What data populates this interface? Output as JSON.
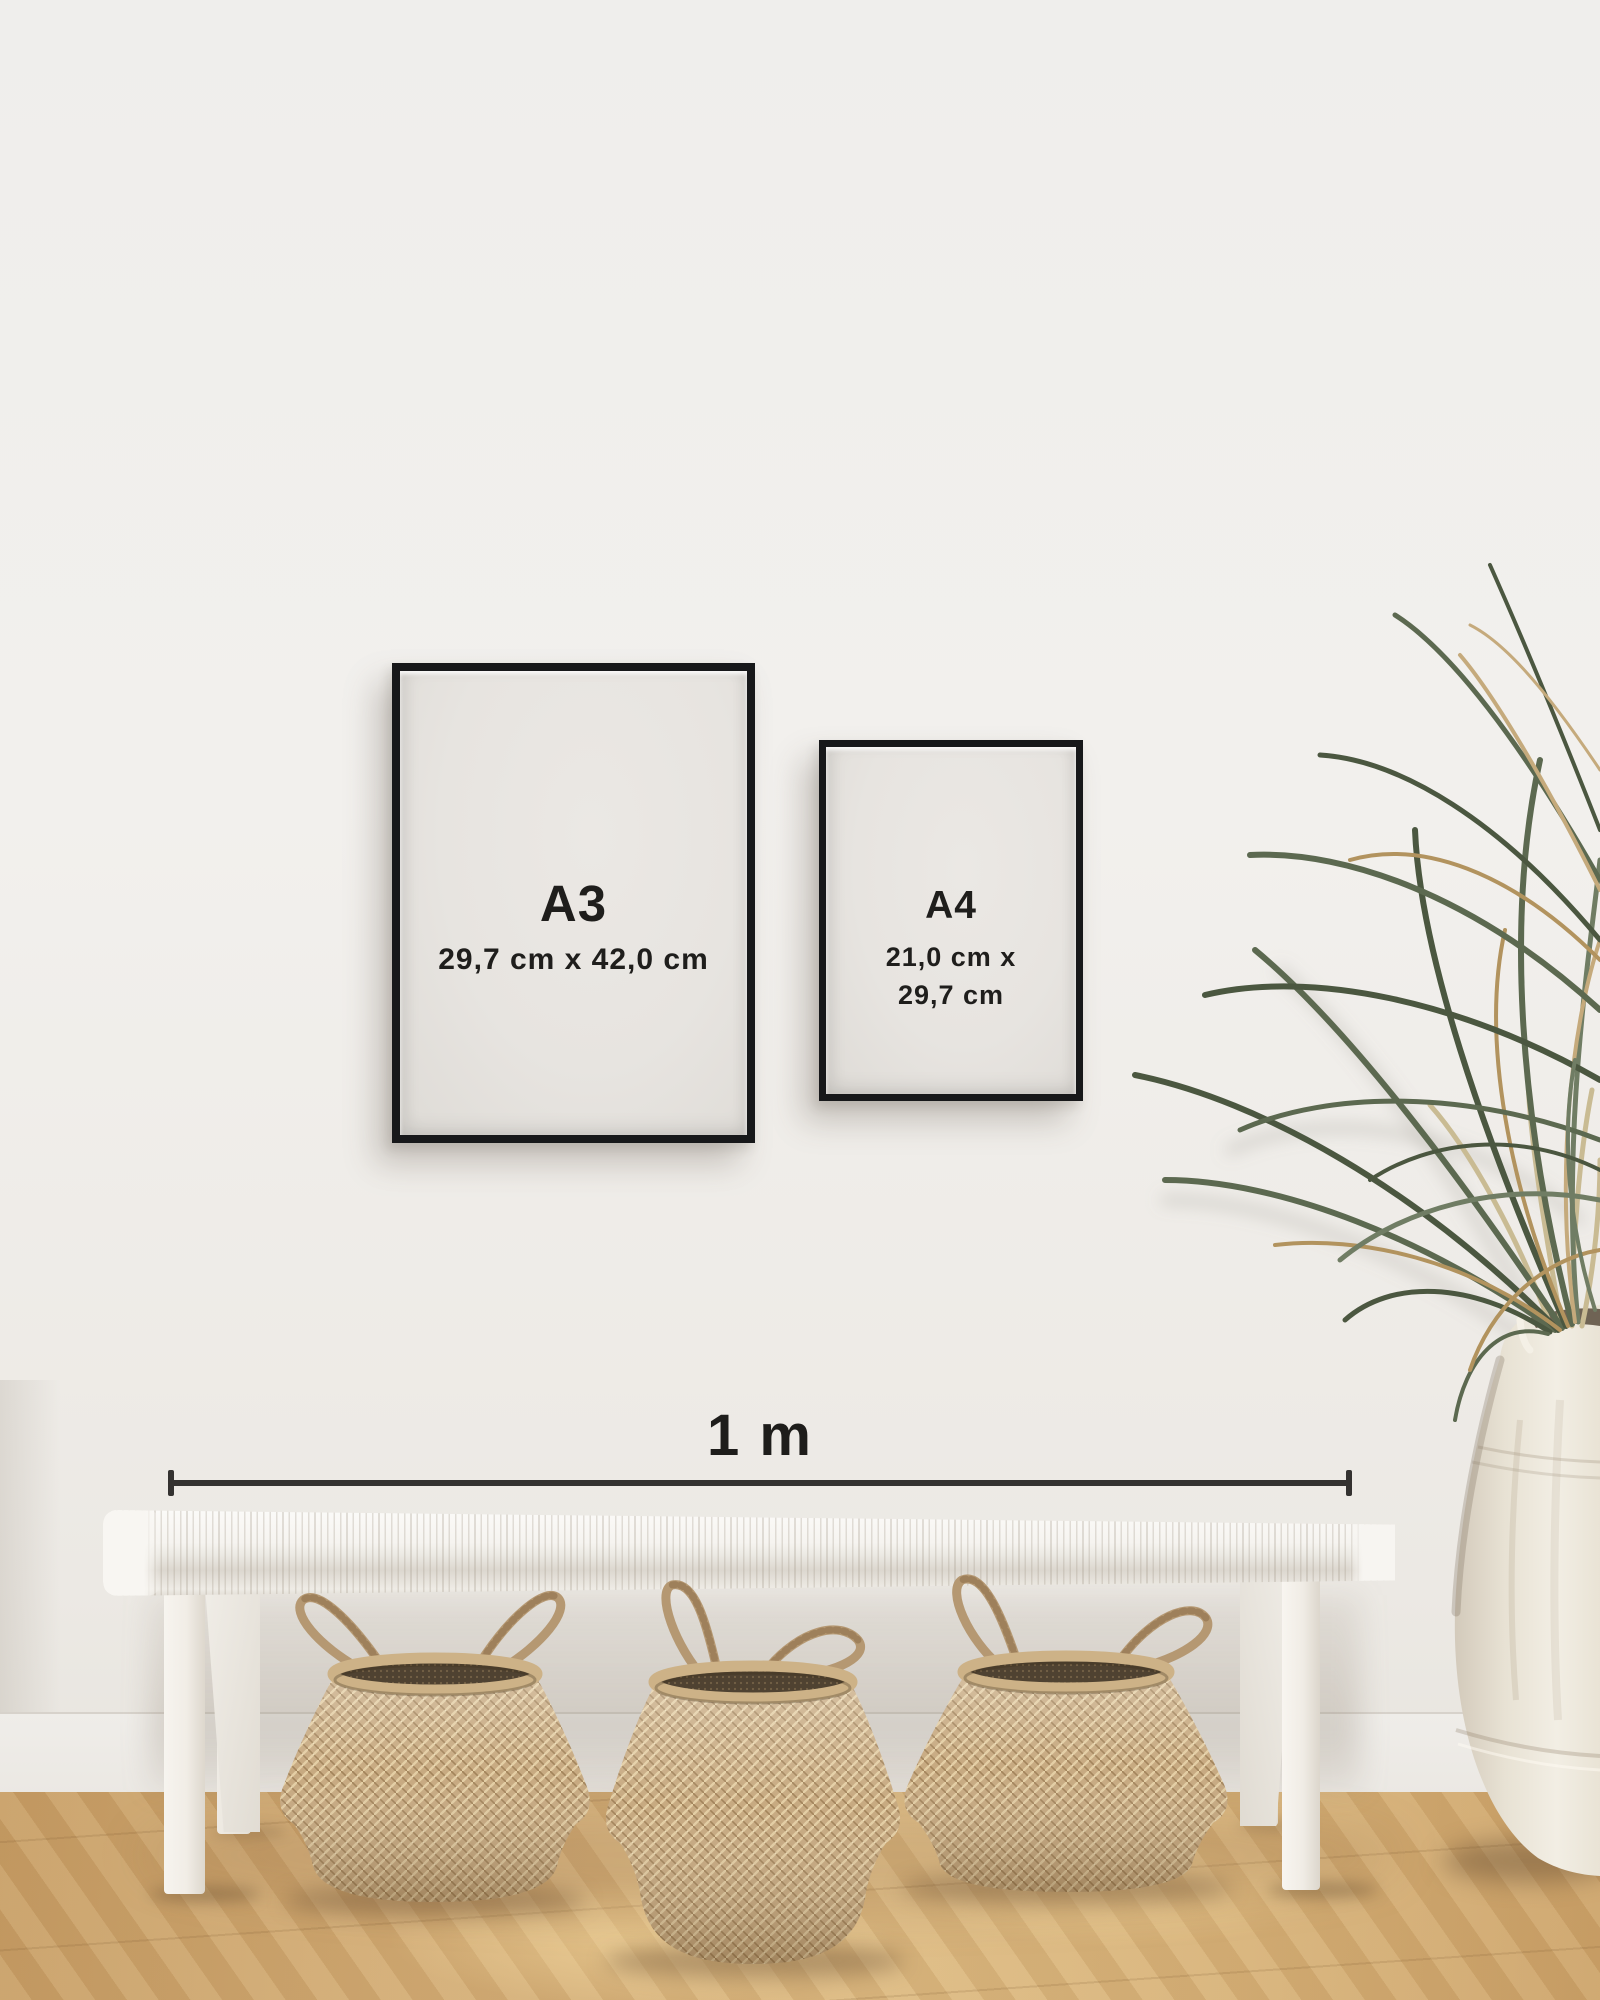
{
  "scene": {
    "type": "poster-size-guide-mockup",
    "wall_color": "#f1efec",
    "floor_wood_color": "#d2ab74"
  },
  "posters": {
    "a3": {
      "label": "A3",
      "size_text": "29,7 cm x 42,0 cm",
      "frame_color": "#17181a",
      "paper_color": "#e8e5e1"
    },
    "a4": {
      "label": "A4",
      "size_line1": "21,0 cm x",
      "size_line2": "29,7 cm",
      "frame_color": "#17181a",
      "paper_color": "#e8e5e1"
    }
  },
  "scale_bar": {
    "label": "1 m",
    "color": "#343230"
  },
  "decor": {
    "bench_color": "#f6f4f0",
    "basket_count": 3,
    "basket_weave_color": "#c4a57a",
    "plant_green_color": "#55614a",
    "plant_dry_leaf_color": "#b2935e",
    "vase_color": "#ece6da"
  }
}
